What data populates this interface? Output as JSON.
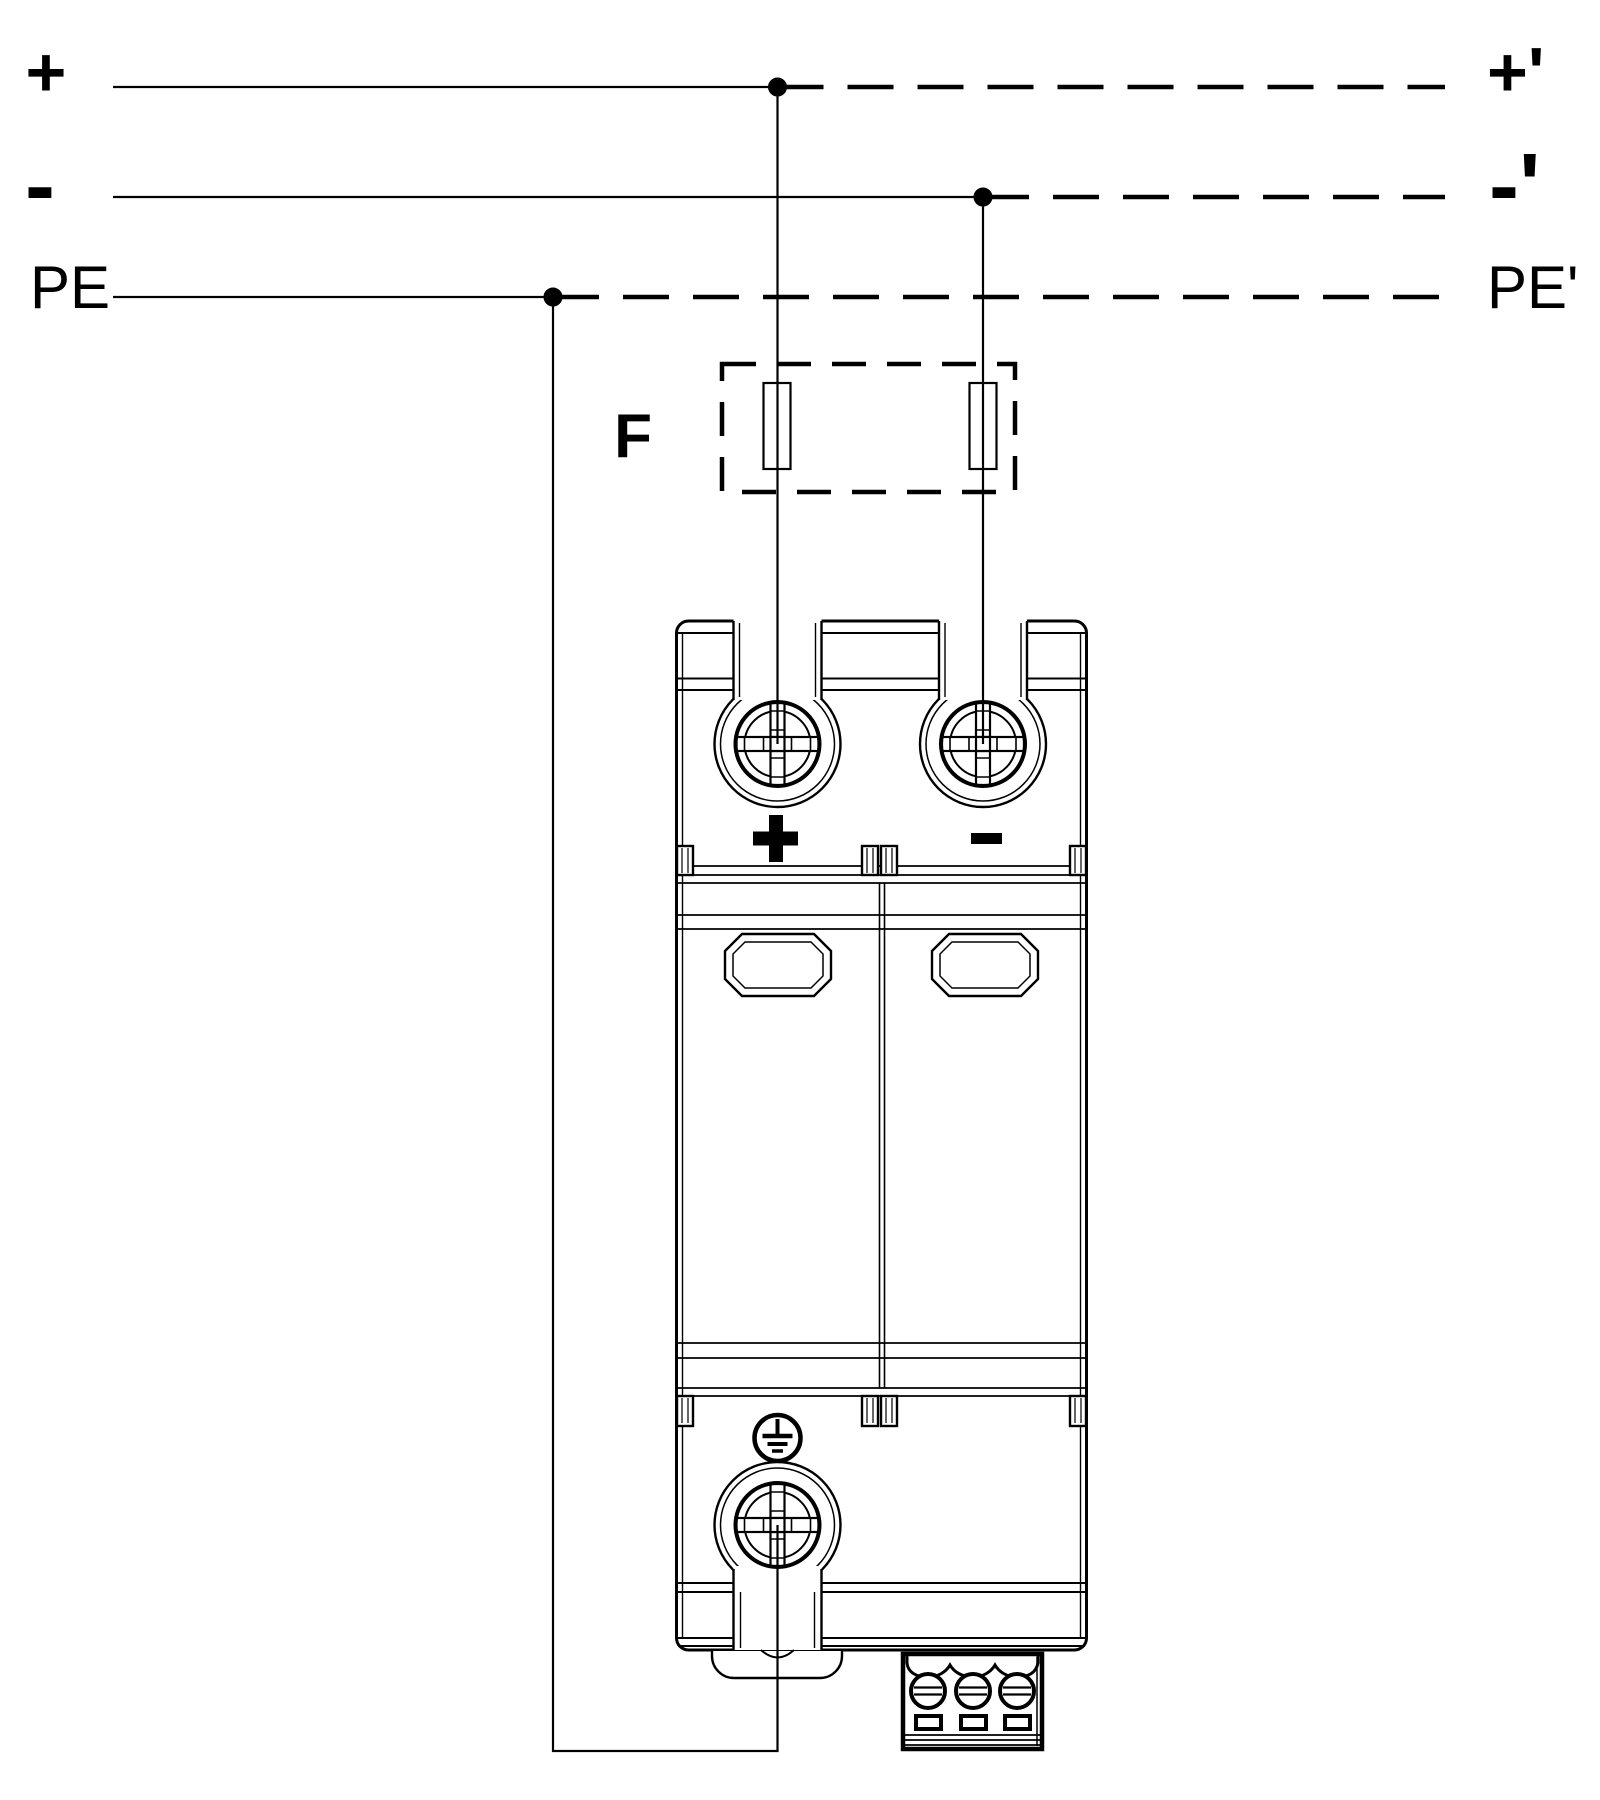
{
  "page": {
    "title": "DC surge protective device wiring diagram",
    "background_color": "#ffffff",
    "line_color": "#000000"
  },
  "schematic": {
    "input_lines": [
      {
        "id": "plus",
        "label": "+"
      },
      {
        "id": "minus",
        "label": "-"
      },
      {
        "id": "pe",
        "label": "PE"
      }
    ],
    "output_lines": [
      {
        "id": "plus_out",
        "label": "+'"
      },
      {
        "id": "minus_out",
        "label": "-'"
      },
      {
        "id": "pe_out",
        "label": "PE'"
      }
    ],
    "fuse": {
      "label": "F"
    },
    "device": {
      "markings": {
        "positive": "+",
        "negative": "-",
        "earth": "protective earth symbol"
      }
    }
  }
}
